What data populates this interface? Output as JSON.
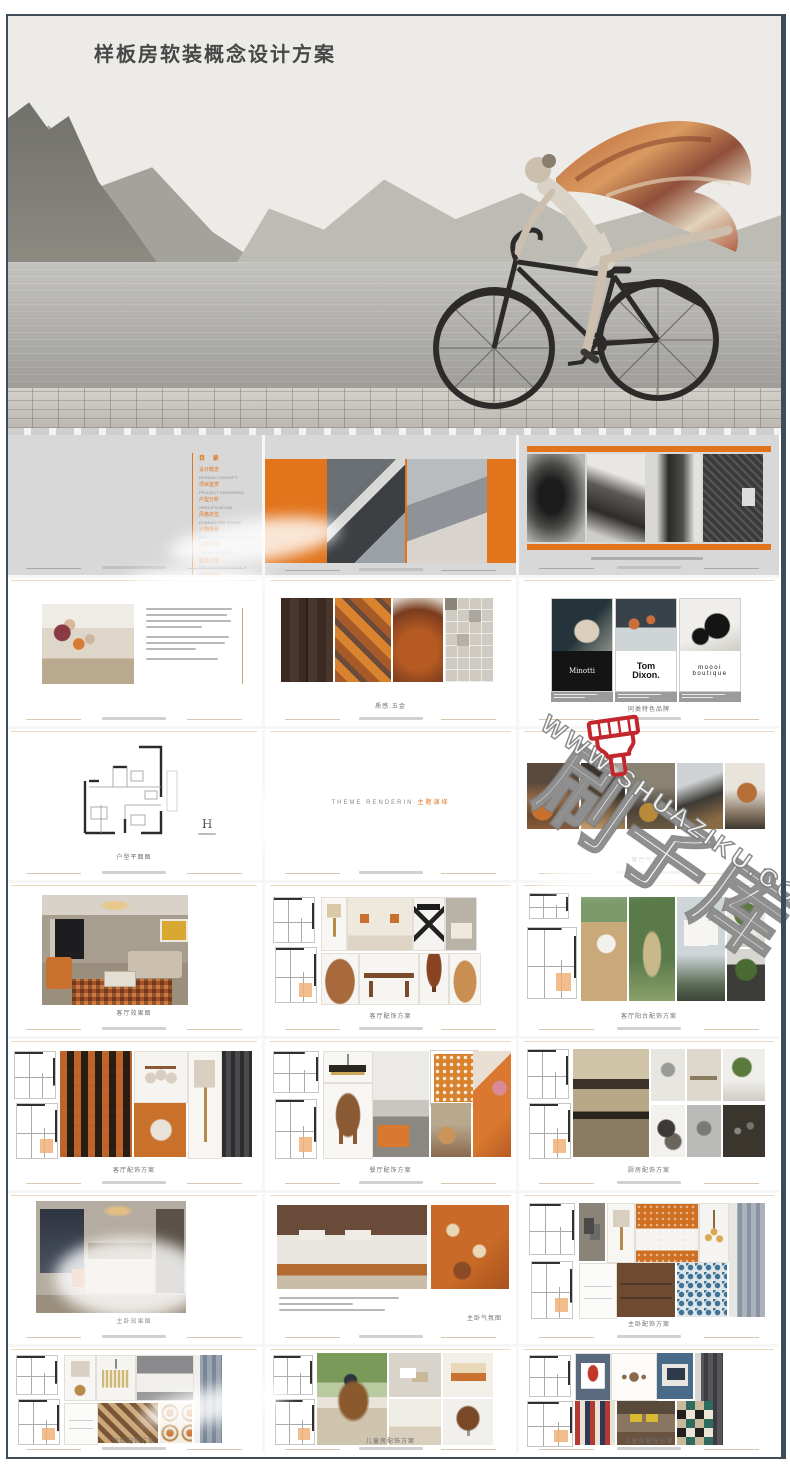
{
  "page": {
    "title": "样板房软装概念设计方案"
  },
  "colors": {
    "accent": "#e2741c",
    "frame": "#3e4c59",
    "brush_red": "#c2272d",
    "slide_gray": "#d8d8d8"
  },
  "watermark": {
    "brand": "刷子库",
    "url": "WWW.SHUAZIKU.COM"
  },
  "toc": {
    "title": "目 录",
    "items": [
      {
        "zh": "设计概念",
        "en": "DESIGN CONCEPT"
      },
      {
        "zh": "项目鉴赏",
        "en": "PROJECT RENDERED"
      },
      {
        "zh": "户型分析",
        "en": "SPECIFICATION"
      },
      {
        "zh": "风格定位",
        "en": "CHARACTER SCENE"
      },
      {
        "zh": "人物场景",
        "en": "STYLE POSITION KEYNOTE"
      },
      {
        "zh": "主题演绎",
        "en": "THEME BOARDS"
      },
      {
        "zh": "配饰方案",
        "en": "DECORATION DETAILS"
      },
      {
        "zh": "空间设计",
        "en": ""
      }
    ]
  },
  "slides": {
    "materials": {
      "caption": "质感.五金"
    },
    "brands": {
      "caption": "同类特色品牌",
      "cards": [
        "Minotti",
        "Tom Dixon.",
        "moooi boutique"
      ]
    },
    "floorplan": {
      "caption": "户型平面图",
      "logo": "H"
    },
    "theme": {
      "en": "THEME RENDERIN",
      "zh": "主题演绎"
    },
    "living_mood": {
      "caption": "客厅气氛图"
    },
    "living_render": {
      "caption": "客厅效果图"
    },
    "living_acc": {
      "caption": "客厅配饰方案"
    },
    "balcony": {
      "caption": "客厅阳台配饰方案"
    },
    "living_soft": {
      "caption": "客厅配饰方案"
    },
    "dining": {
      "caption": "餐厅配饰方案"
    },
    "kitchen": {
      "caption": "厨房配饰方案"
    },
    "master_render": {
      "caption": "主卧效果图"
    },
    "master_mood": {
      "caption": "主卧气氛图"
    },
    "master_acc": {
      "caption": "主卧配饰方案"
    },
    "bed2": {
      "caption": "次卧配饰方案"
    },
    "kids_mood": {
      "caption": "儿童房配饰方案"
    },
    "kids_acc": {
      "caption": "儿童房配饰方案"
    }
  }
}
